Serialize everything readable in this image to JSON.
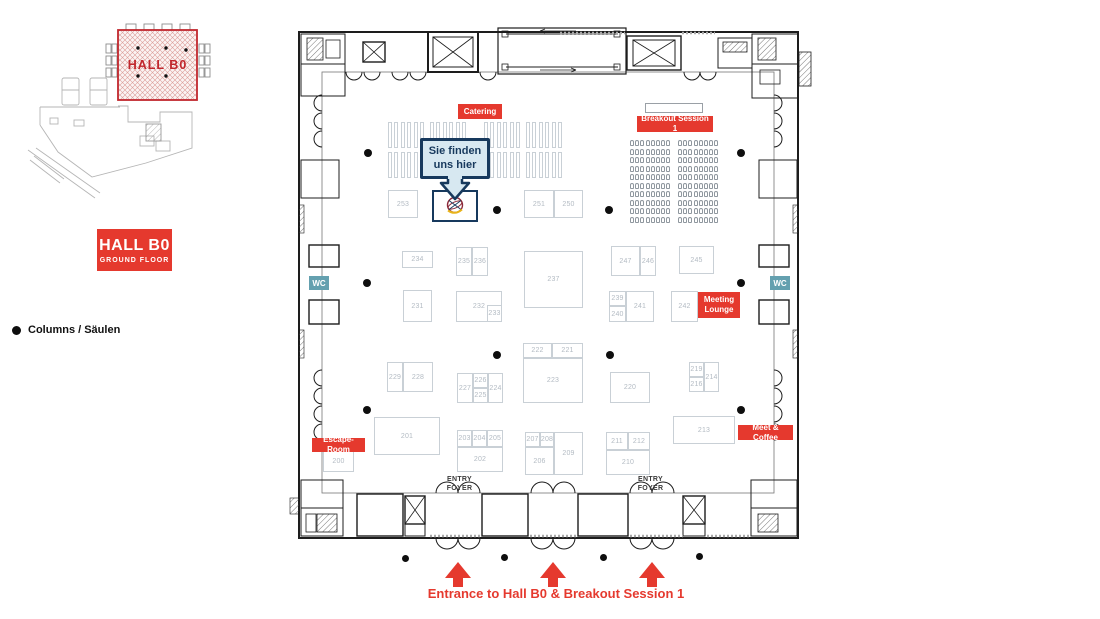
{
  "colors": {
    "red": "#e5392e",
    "teal": "#64a0af",
    "navy": "#17395d",
    "callout_bg": "#d7e8f1",
    "booth_border": "#c9d0d6",
    "booth_text": "#b3bbc3",
    "dot": "#0e0e0e",
    "minimap_red": "#c1272d",
    "wall": "#1d1d1d"
  },
  "minimap": {
    "hall_label": "HALL B0"
  },
  "hall_badge": {
    "title": "HALL B0",
    "subtitle": "GROUND FLOOR"
  },
  "legend": {
    "columns": "Columns / Säulen"
  },
  "callout": {
    "line1": "Sie finden",
    "line2": "uns hier"
  },
  "labels": {
    "catering": "Catering",
    "breakout": "Breakout Session 1",
    "meeting_lounge": "Meeting Lounge",
    "meet_coffee": "Meet & Coffee",
    "escape_room": "Escape-Room",
    "wc": "WC"
  },
  "entry_foyer": {
    "line1": "ENTRY",
    "line2": "FOYER"
  },
  "entrance": {
    "label": "Entrance to Hall B0 & Breakout Session 1"
  },
  "map": {
    "booths": [
      {
        "n": "253",
        "x": 388,
        "y": 190,
        "w": 30,
        "h": 28
      },
      {
        "n": "251",
        "x": 524,
        "y": 190,
        "w": 30,
        "h": 28
      },
      {
        "n": "250",
        "x": 554,
        "y": 190,
        "w": 29,
        "h": 28
      },
      {
        "n": "234",
        "x": 402,
        "y": 251,
        "w": 31,
        "h": 17
      },
      {
        "n": "235",
        "x": 456,
        "y": 247,
        "w": 16,
        "h": 29
      },
      {
        "n": "236",
        "x": 472,
        "y": 247,
        "w": 16,
        "h": 29
      },
      {
        "n": "237",
        "x": 524,
        "y": 251,
        "w": 59,
        "h": 57
      },
      {
        "n": "231",
        "x": 403,
        "y": 290,
        "w": 29,
        "h": 32
      },
      {
        "n": "232",
        "x": 456,
        "y": 291,
        "w": 46,
        "h": 31
      },
      {
        "n": "233",
        "x": 487,
        "y": 305,
        "w": 15,
        "h": 17
      },
      {
        "n": "247",
        "x": 611,
        "y": 246,
        "w": 29,
        "h": 30
      },
      {
        "n": "246",
        "x": 640,
        "y": 246,
        "w": 16,
        "h": 30
      },
      {
        "n": "245",
        "x": 679,
        "y": 246,
        "w": 35,
        "h": 28
      },
      {
        "n": "239",
        "x": 609,
        "y": 291,
        "w": 17,
        "h": 15
      },
      {
        "n": "240",
        "x": 609,
        "y": 306,
        "w": 17,
        "h": 16
      },
      {
        "n": "241",
        "x": 626,
        "y": 291,
        "w": 28,
        "h": 31
      },
      {
        "n": "242",
        "x": 671,
        "y": 291,
        "w": 27,
        "h": 31
      },
      {
        "n": "222",
        "x": 523,
        "y": 343,
        "w": 29,
        "h": 15
      },
      {
        "n": "221",
        "x": 552,
        "y": 343,
        "w": 31,
        "h": 15
      },
      {
        "n": "223",
        "x": 523,
        "y": 358,
        "w": 60,
        "h": 45
      },
      {
        "n": "229",
        "x": 387,
        "y": 362,
        "w": 16,
        "h": 30
      },
      {
        "n": "228",
        "x": 403,
        "y": 362,
        "w": 30,
        "h": 30
      },
      {
        "n": "227",
        "x": 457,
        "y": 373,
        "w": 16,
        "h": 30
      },
      {
        "n": "226",
        "x": 473,
        "y": 373,
        "w": 15,
        "h": 15
      },
      {
        "n": "225",
        "x": 473,
        "y": 388,
        "w": 15,
        "h": 15
      },
      {
        "n": "224",
        "x": 488,
        "y": 373,
        "w": 15,
        "h": 30
      },
      {
        "n": "220",
        "x": 610,
        "y": 372,
        "w": 40,
        "h": 31
      },
      {
        "n": "219",
        "x": 689,
        "y": 362,
        "w": 15,
        "h": 15
      },
      {
        "n": "216",
        "x": 689,
        "y": 377,
        "w": 15,
        "h": 15
      },
      {
        "n": "214",
        "x": 704,
        "y": 362,
        "w": 15,
        "h": 30
      },
      {
        "n": "213",
        "x": 673,
        "y": 416,
        "w": 62,
        "h": 28
      },
      {
        "n": "201",
        "x": 374,
        "y": 417,
        "w": 66,
        "h": 38
      },
      {
        "n": "200",
        "x": 323,
        "y": 450,
        "w": 31,
        "h": 22
      },
      {
        "n": "203",
        "x": 457,
        "y": 430,
        "w": 15,
        "h": 17
      },
      {
        "n": "204",
        "x": 472,
        "y": 430,
        "w": 15,
        "h": 17
      },
      {
        "n": "205",
        "x": 487,
        "y": 430,
        "w": 16,
        "h": 17
      },
      {
        "n": "202",
        "x": 457,
        "y": 447,
        "w": 46,
        "h": 25
      },
      {
        "n": "207",
        "x": 525,
        "y": 432,
        "w": 15,
        "h": 15
      },
      {
        "n": "208",
        "x": 540,
        "y": 432,
        "w": 14,
        "h": 15
      },
      {
        "n": "206",
        "x": 525,
        "y": 447,
        "w": 29,
        "h": 28
      },
      {
        "n": "209",
        "x": 554,
        "y": 432,
        "w": 29,
        "h": 43
      },
      {
        "n": "211",
        "x": 606,
        "y": 432,
        "w": 22,
        "h": 18
      },
      {
        "n": "212",
        "x": 628,
        "y": 432,
        "w": 22,
        "h": 18
      },
      {
        "n": "210",
        "x": 606,
        "y": 450,
        "w": 44,
        "h": 25
      }
    ],
    "columns_inside": [
      [
        368,
        153
      ],
      [
        741,
        153
      ],
      [
        497,
        210
      ],
      [
        609,
        210
      ],
      [
        367,
        283
      ],
      [
        741,
        283
      ],
      [
        497,
        355
      ],
      [
        610,
        355
      ],
      [
        367,
        410
      ],
      [
        741,
        410
      ]
    ],
    "columns_outside": [
      [
        405,
        558
      ],
      [
        504,
        557
      ],
      [
        603,
        557
      ],
      [
        699,
        556
      ]
    ],
    "catering_rows": [
      122,
      152
    ],
    "catering_groups": [
      388,
      430,
      484,
      526
    ],
    "chair_blocks": [
      630,
      678
    ],
    "arrow_centers": [
      458,
      553,
      652
    ]
  }
}
